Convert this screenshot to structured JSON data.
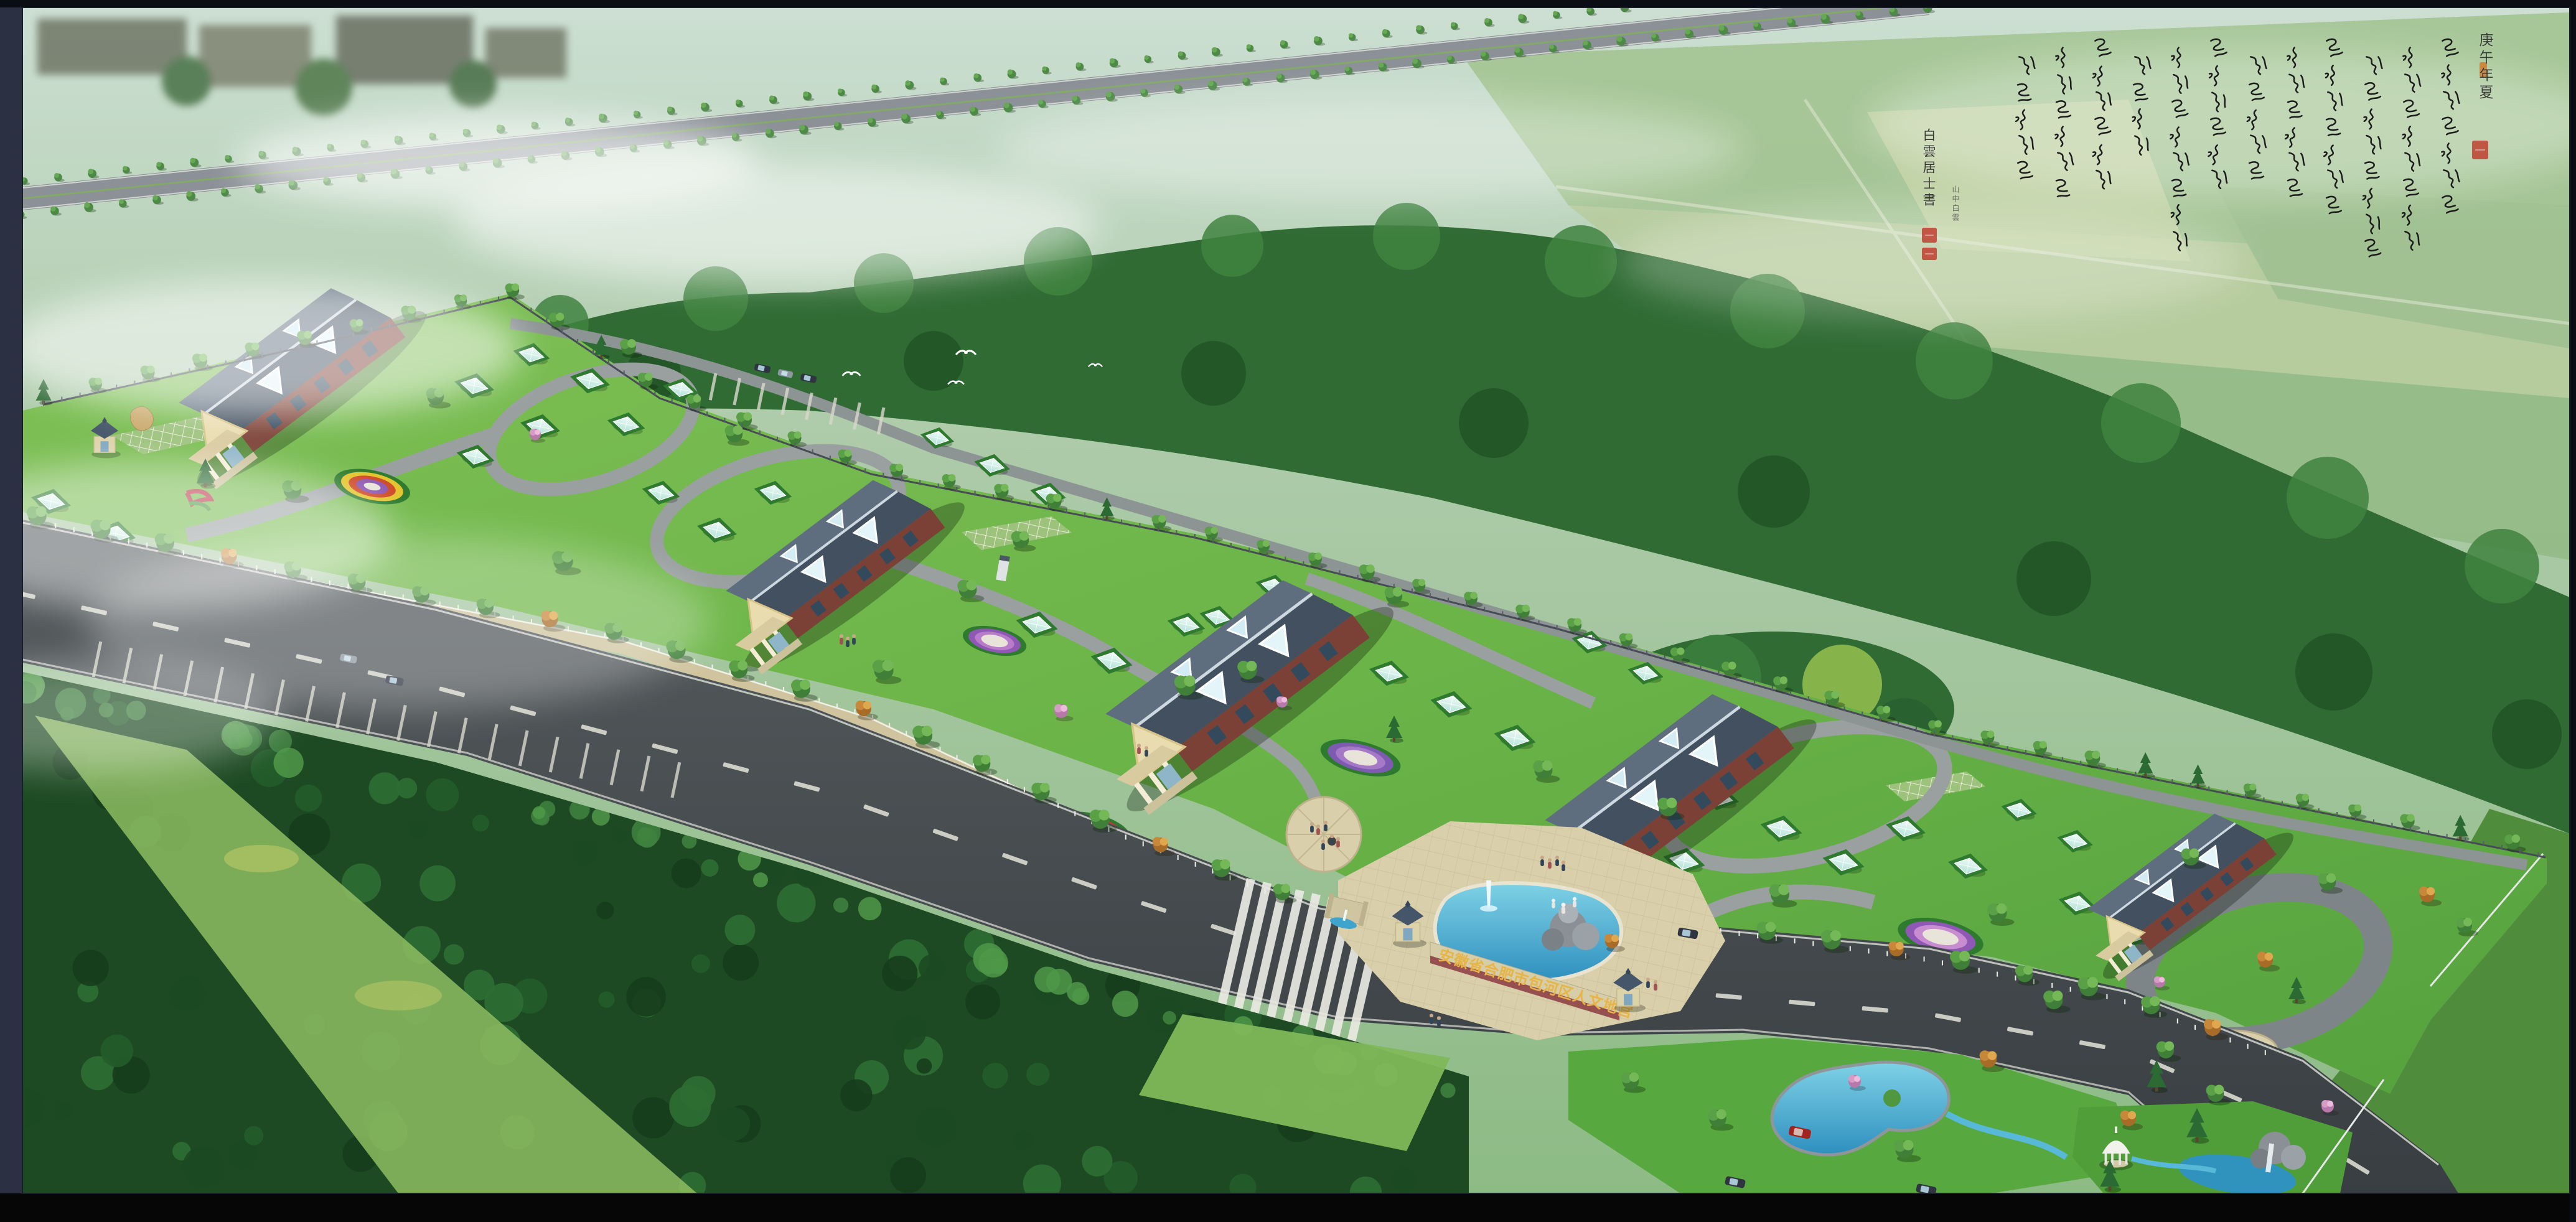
{
  "artwork": {
    "kind": "aerial-perspective landscape architectural rendering (photomontage)",
    "entrance_sign": {
      "text": "安徽省合肥市包河区人文地宫",
      "text_color": "#e8b443",
      "wall_color": "#d6cda9"
    },
    "calligraphy": {
      "date_inscription": "庚午年夏",
      "signature": "白雲居士書",
      "secondary_inscription": "山中白雲",
      "ink_color": "#1c1c1c",
      "body_columns": 12,
      "column_glyph_counts": [
        7,
        8,
        8,
        7,
        6,
        5,
        6,
        8,
        4,
        6,
        6,
        5
      ],
      "body_legible": false,
      "seal_color": "#c0392b",
      "seal_accent_color": "#d07828",
      "seal_count": 4
    },
    "scene_inventory": {
      "gable_roof_halls": 5,
      "glass_pyramid_skylights": 36,
      "gatehouse_kiosks": 3,
      "fountain_pool": 1,
      "rockery_sculpture": 1,
      "circular_plaza": 1,
      "kidney_pond": 1,
      "waterfall_rockery": 1,
      "white_gazebo": 1,
      "streams": 2,
      "flying_birds": 4,
      "cars": 9,
      "visitor_groups": 6,
      "tree_lined_avenue": true,
      "main_road_with_crosswalk": true,
      "perimeter_fence": true,
      "parking_bays": true
    },
    "palette": {
      "mist": "#cfe0d2",
      "field": "#a9c8a4",
      "forest": "#2f6b33",
      "lawn": "#6fb84d",
      "asphalt": "#3c4245",
      "water": "#3fa4cb",
      "roof_slate": "#46566a",
      "brick": "#7c4136",
      "cream": "#e9dcae",
      "paving": "#d9d0ab",
      "frame": "#0b0d14",
      "mat_board": "#2b3042"
    }
  }
}
